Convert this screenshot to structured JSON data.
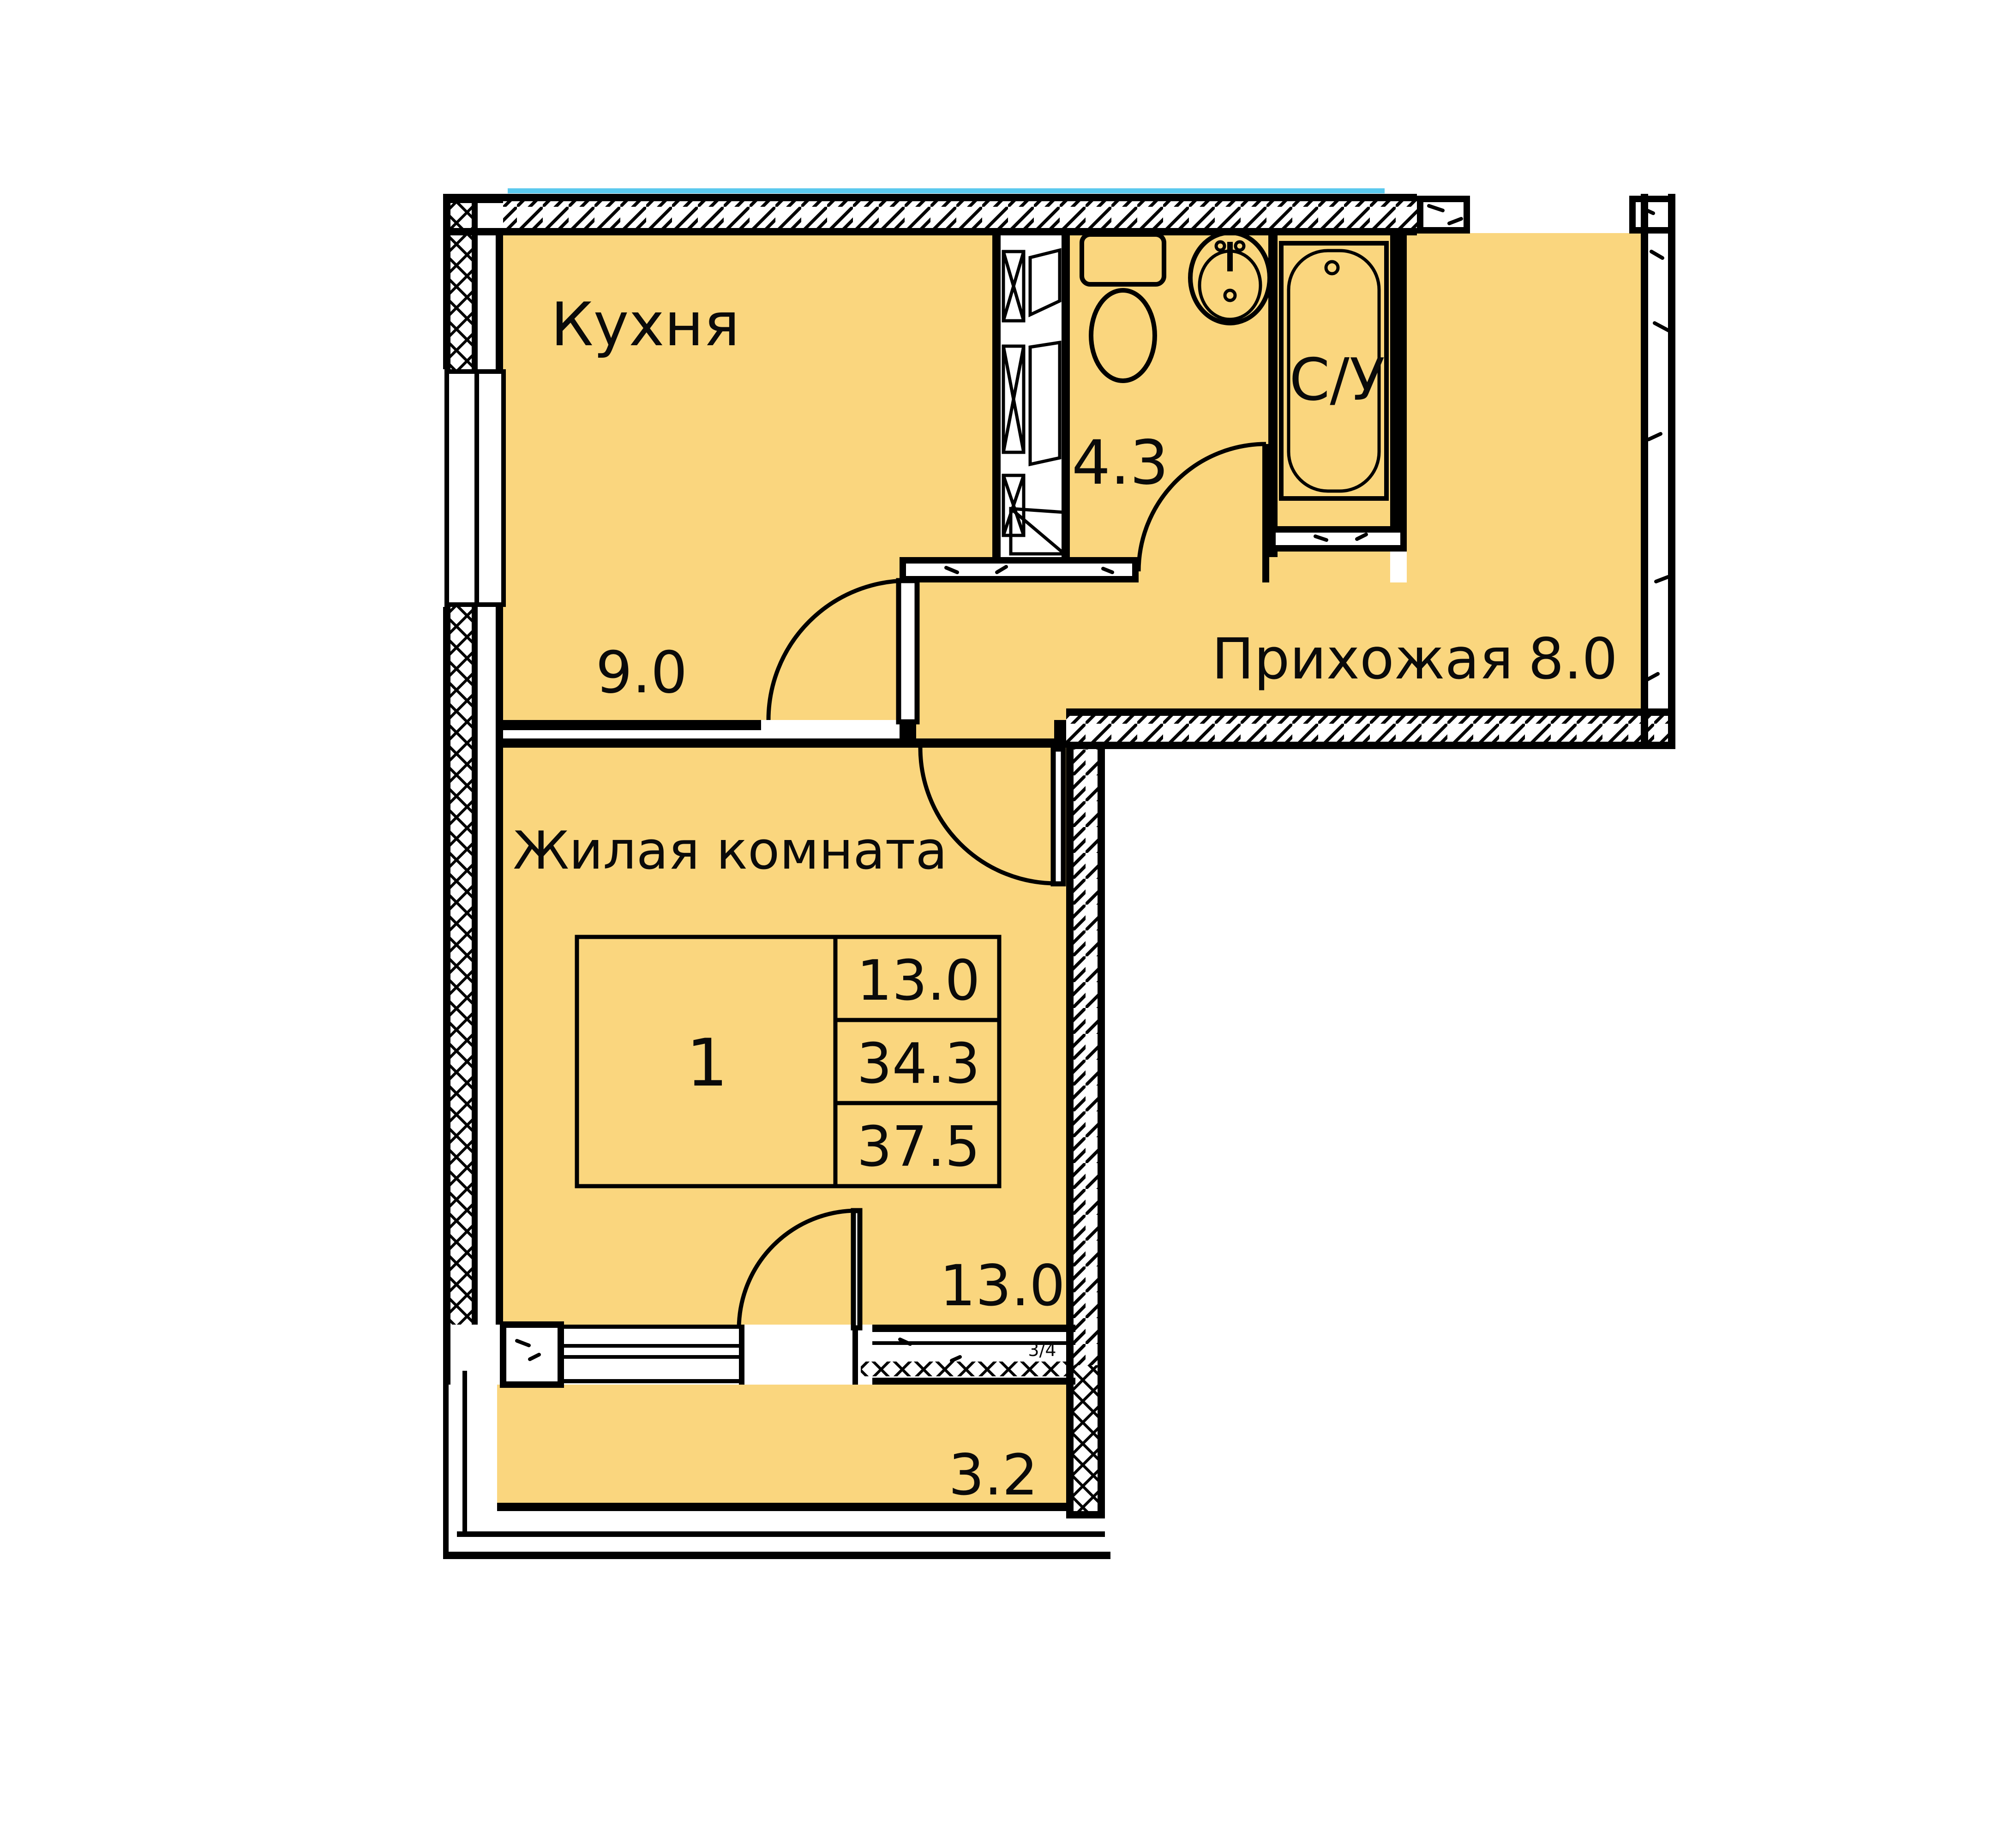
{
  "plan": {
    "type": "apartment-floor-plan",
    "language": "ru",
    "colors": {
      "room_fill": "#FAD67E",
      "wall": "#000000",
      "glazing_accent": "#5BC9EE"
    },
    "rooms": {
      "kitchen": {
        "name": "Кухня",
        "area": "9.0"
      },
      "bathroom": {
        "name": "С/У",
        "area": "4.3"
      },
      "hallway": {
        "name": "Прихожая",
        "area": "8.0"
      },
      "living": {
        "name": "Жилая комната",
        "area": "13.0"
      },
      "balcony": {
        "area": "3.2"
      }
    },
    "stamp": {
      "rooms_count": "1",
      "living_area": "13.0",
      "area_no_balcony": "34.3",
      "total_area": "37.5"
    },
    "annotations": {
      "sill_mark": "3/4"
    }
  }
}
